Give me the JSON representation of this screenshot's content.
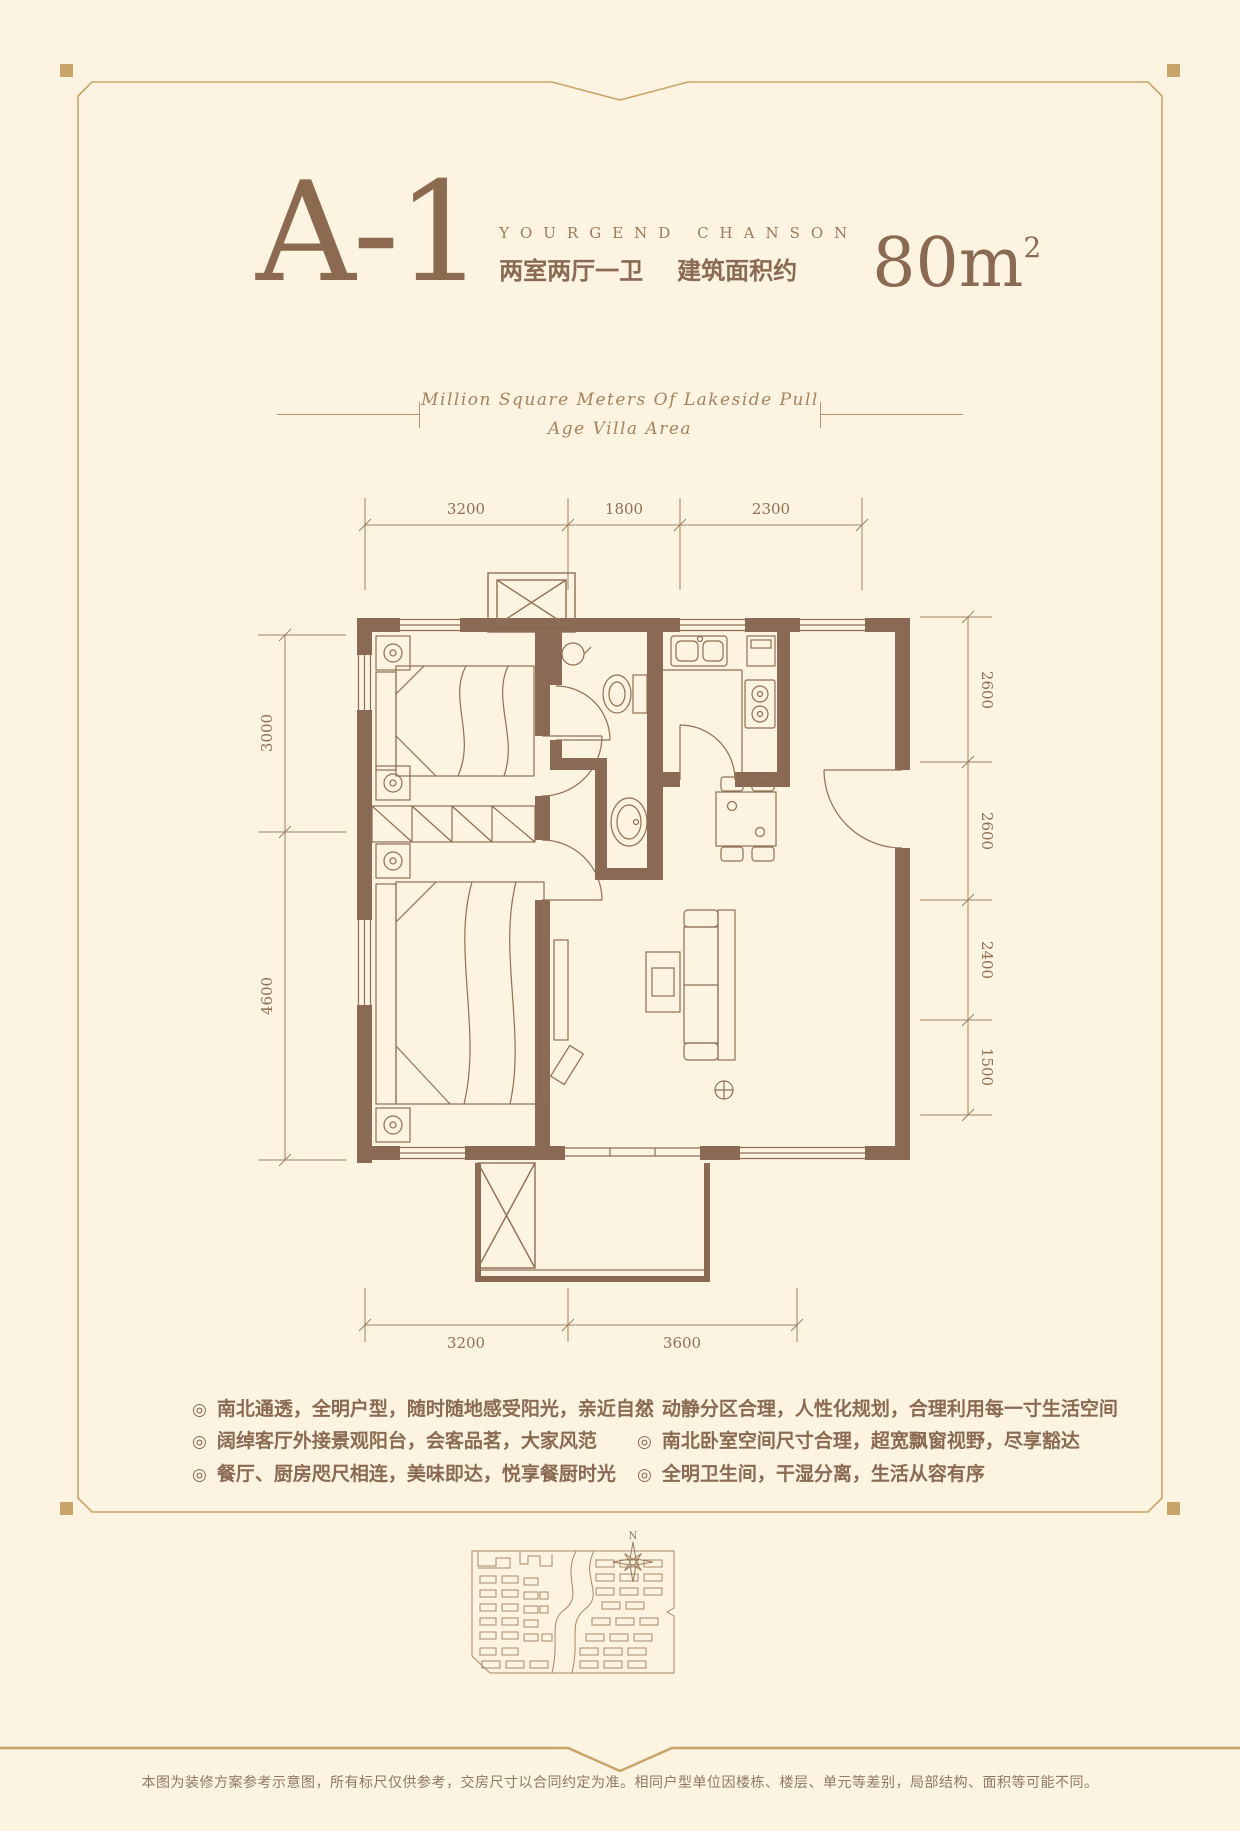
{
  "page": {
    "background": "#fcf3e0",
    "accent_gold": "#c8a469",
    "accent_brown": "#8a6a52"
  },
  "header": {
    "unit_code": "A-1",
    "subtitle": "YOURGEND CHANSON",
    "layout_text": "两室两厅一卫",
    "area_label": "建筑面积约",
    "area_value": "80m",
    "area_superscript": "2"
  },
  "tagline": {
    "line1": "Million Square Meters Of Lakeside Pull",
    "line2": "Age Villa Area"
  },
  "floorplan": {
    "dims_top": [
      "3200",
      "1800",
      "2300"
    ],
    "dims_left": [
      "3000",
      "4600"
    ],
    "dims_right": [
      "2600",
      "2600",
      "2400",
      "1500"
    ],
    "dims_bottom": [
      "3200",
      "3600"
    ]
  },
  "features": {
    "left": [
      "南北通透，全明户型，随时随地感受阳光，亲近自然",
      "阔绰客厅外接景观阳台，会客品茗，大家风范",
      "餐厅、厨房咫尺相连，美味即达，悦享餐厨时光"
    ],
    "right": [
      "动静分区合理，人性化规划，合理利用每一寸生活空间",
      "南北卧室空间尺寸合理，超宽飘窗视野，尽享豁达",
      "全明卫生间，干湿分离，生活从容有序"
    ]
  },
  "compass": {
    "label": "N"
  },
  "footer": {
    "disclaimer": "本图为装修方案参考示意图，所有标尺仅供参考，交房尺寸以合同约定为准。相同户型单位因楼栋、楼层、单元等差别，局部结构、面积等可能不同。"
  }
}
